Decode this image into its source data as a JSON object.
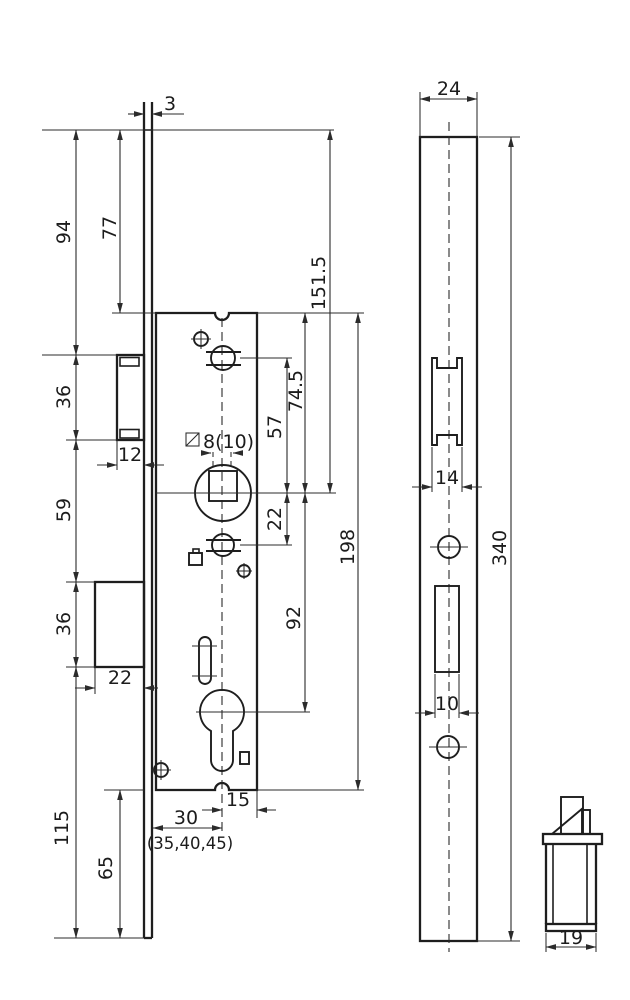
{
  "front_view": {
    "dim_faceplate_thickness": "3",
    "dim_plate_top_to_latch": "94",
    "dim_plate_top_to_case": "77",
    "dim_plate_top_to_spindle": "151.5",
    "dim_latch_height": "36",
    "dim_latch_projection": "12",
    "dim_latch_to_deadbolt": "59",
    "dim_case_top_to_spindle": "74.5",
    "dim_hub_to_spindle": "57",
    "dim_spindle_to_lower_hub": "22",
    "dim_case_height": "198",
    "dim_spindle_to_cylinder": "92",
    "dim_deadbolt_height": "36",
    "dim_deadbolt_projection": "22",
    "dim_deadbolt_to_plate_bottom": "115",
    "dim_case_to_plate_bottom": "65",
    "dim_backset": "30",
    "dim_backset_options": "(35,40,45)",
    "dim_center_to_case_back": "15",
    "spindle_square_label": "8(10)"
  },
  "side_view": {
    "dim_faceplate_width": "24",
    "dim_latch_cutout_width": "14",
    "dim_faceplate_length": "340",
    "dim_deadbolt_cutout_width": "10"
  },
  "detail_view": {
    "dim_latch_body_width": "19"
  }
}
